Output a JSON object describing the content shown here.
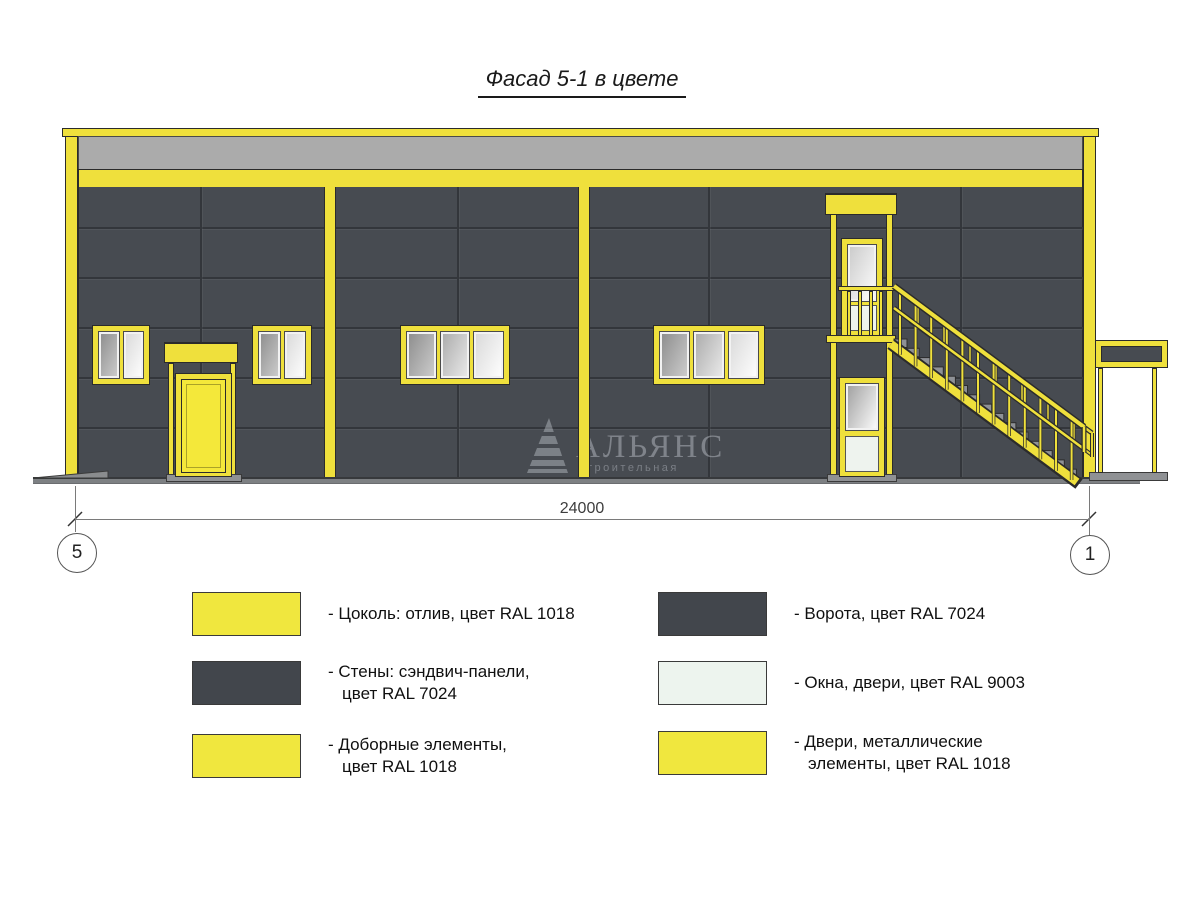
{
  "title": "Фасад 5-1 в цвете",
  "drawing": {
    "dimension_value": "24000",
    "axis_left": "5",
    "axis_right": "1",
    "watermark_name": "АЛЬЯНС",
    "watermark_tagline": "строительная компания"
  },
  "colors": {
    "yellow_ral1018": "#EFE03C",
    "dark_ral7024": "#474B51",
    "light_ral9003": "#EEF3EE",
    "parapet_gray": "#ABABAB",
    "ground_gray": "#7D8083"
  },
  "legend": {
    "columns": [
      {
        "items": [
          {
            "swatch": "#F0E73E",
            "lines": [
              "- Цоколь: отлив, цвет RAL 1018",
              ""
            ]
          },
          {
            "swatch": "#42464C",
            "lines": [
              "- Стены: сэндвич-панели,",
              "цвет RAL 7024"
            ]
          },
          {
            "swatch": "#F0E73E",
            "lines": [
              "- Доборные элементы,",
              "цвет RAL 1018"
            ]
          }
        ]
      },
      {
        "items": [
          {
            "swatch": "#42464C",
            "lines": [
              "- Ворота, цвет RAL 7024",
              ""
            ]
          },
          {
            "swatch": "#EDF4EE",
            "lines": [
              "- Окна, двери, цвет RAL 9003",
              ""
            ]
          },
          {
            "swatch": "#F0E73E",
            "lines": [
              "- Двери, металлические",
              "элементы, цвет RAL 1018"
            ]
          }
        ]
      }
    ]
  }
}
